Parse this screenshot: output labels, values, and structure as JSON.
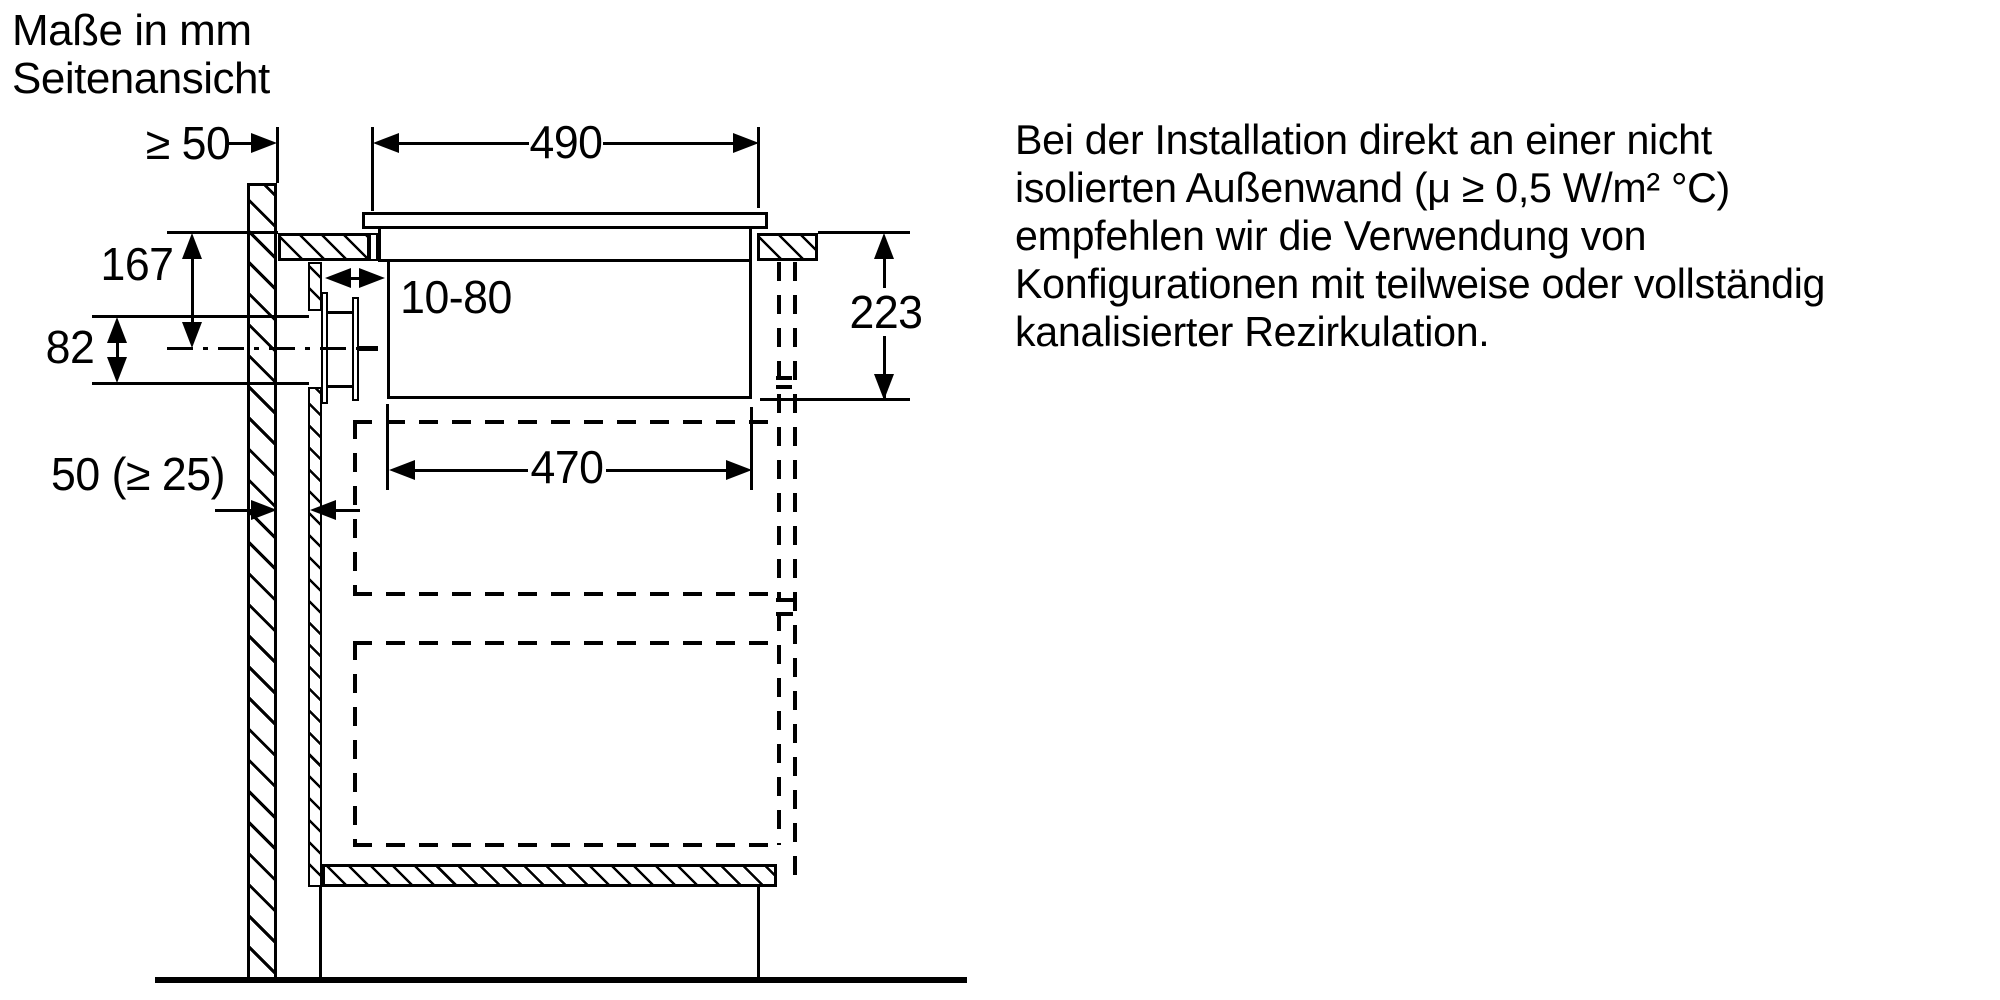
{
  "title": {
    "line1": "Maße in mm",
    "line2": "Seitenansicht"
  },
  "dimensions": {
    "wall_side_clearance": "≥ 50",
    "worktop_cutout_width": "490",
    "duct_axis_below_worktop": "167",
    "duct_extension_range": "10-80",
    "flat_duct_height": "82",
    "installation_depth": "223",
    "wall_rear_gap": "50 (≥ 25)",
    "appliance_body_width": "470"
  },
  "note": {
    "lines": [
      "Bei der Installation direkt an einer nicht",
      "isolierten Außenwand (μ ≥ 0,5 W/m² °C)",
      "empfehlen wir die Verwendung von",
      "Konfigurationen mit teilweise oder vollständig",
      "kanalisierter Rezirkulation."
    ]
  },
  "colors": {
    "line": "#000000",
    "background": "#ffffff"
  }
}
